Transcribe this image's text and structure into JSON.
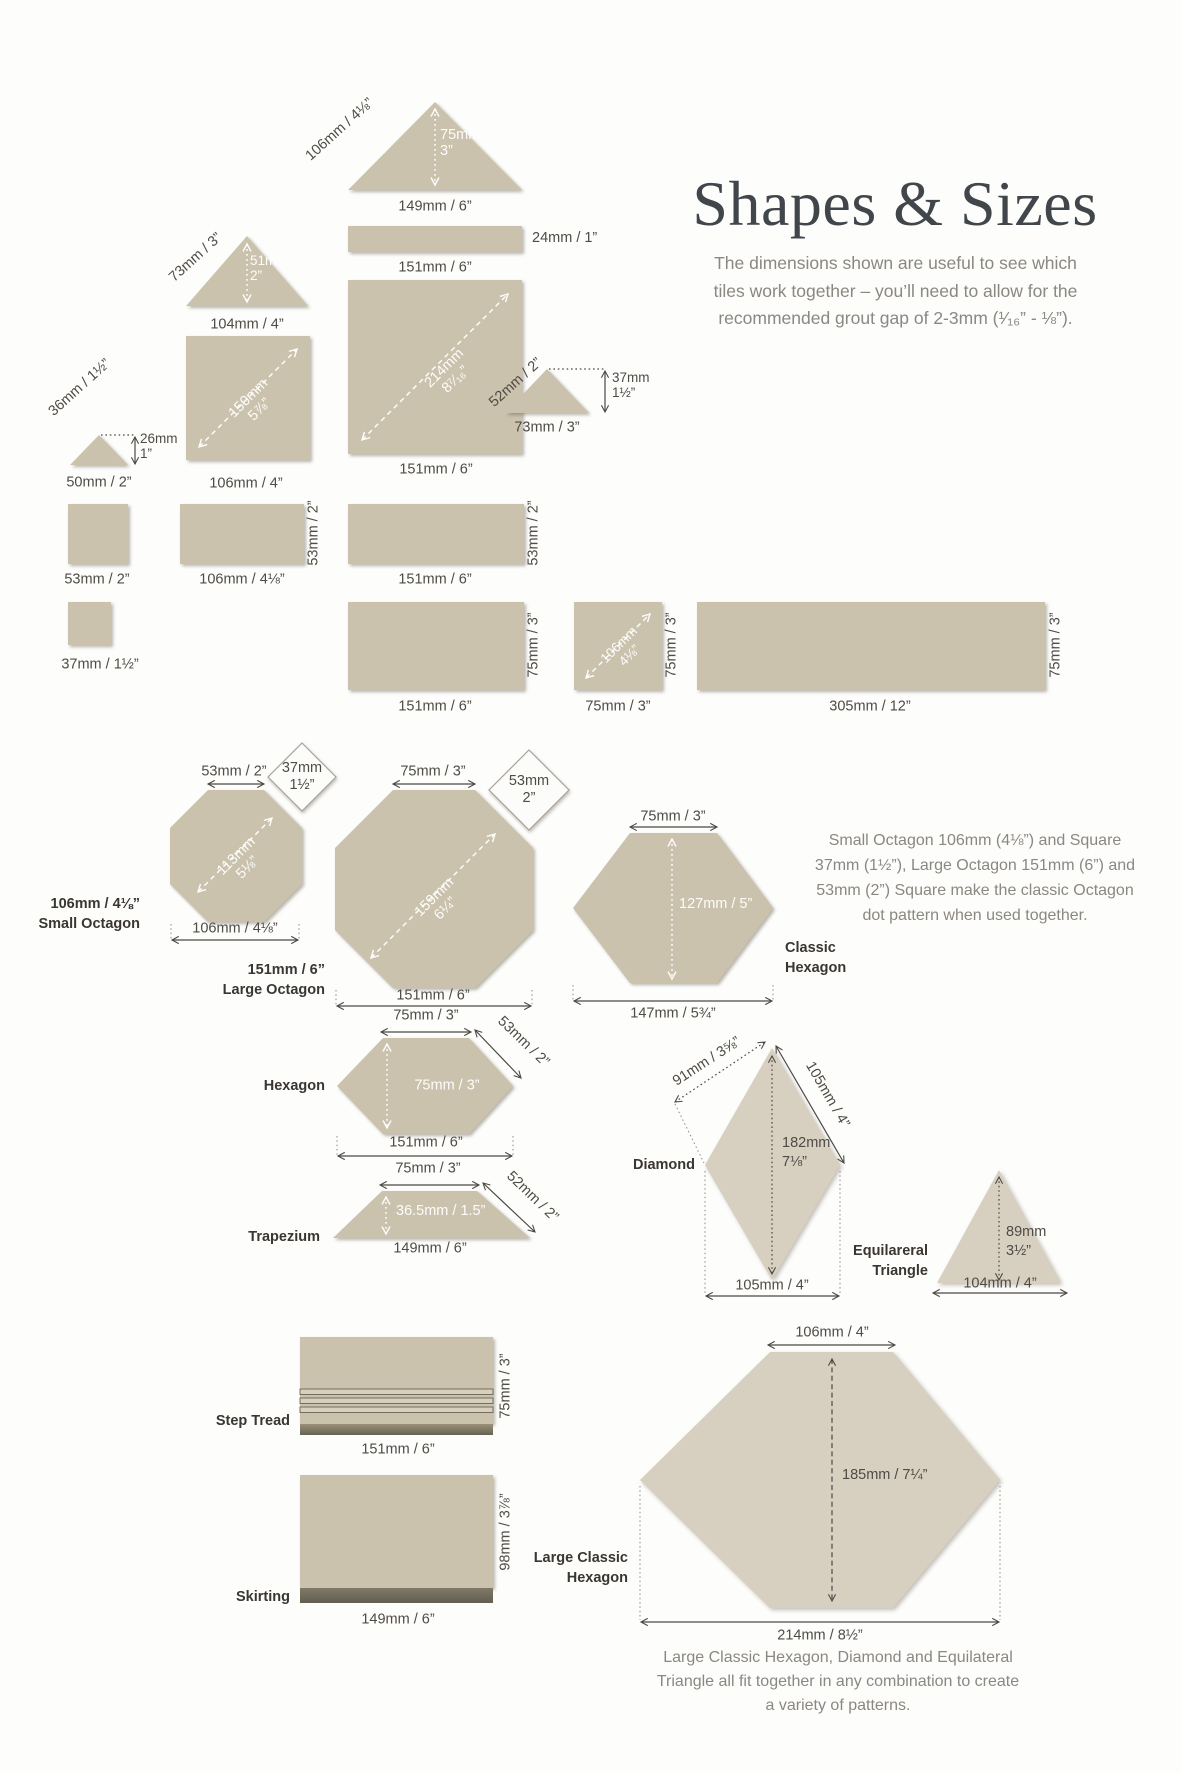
{
  "title": "Shapes & Sizes",
  "intro": {
    "l1": "The dimensions shown are useful to see which",
    "l2": "tiles work together – you’ll need to allow for the",
    "l3": "recommended grout gap of 2-3mm (¹⁄₁₆” - ⅛”)."
  },
  "top": {
    "tri149": {
      "slope": "106mm / 4⅛”",
      "h1": "75mm",
      "h2": "3”",
      "base": "149mm / 6”"
    },
    "strip24": {
      "side": "24mm / 1”",
      "base": "151mm / 6”"
    },
    "sq151": {
      "d1": "214mm",
      "d2": "8⁷⁄₁₆”",
      "base": "151mm / 6”"
    },
    "tri104": {
      "slope": "73mm / 3”",
      "h1": "51mm",
      "h2": "2”",
      "base": "104mm / 4”"
    },
    "sq106": {
      "d1": "150mm",
      "d2": "5⅞”",
      "base": "106mm / 4”"
    },
    "tri50": {
      "slope": "36mm / 1½”",
      "h1": "26mm",
      "h2": "1”",
      "base": "50mm / 2”"
    },
    "tri73": {
      "slope": "52mm / 2”",
      "h1": "37mm",
      "h2": "1½”",
      "base": "73mm / 3”"
    }
  },
  "row53": {
    "sq53": {
      "base": "53mm / 2”"
    },
    "rect106": {
      "side": "53mm / 2”",
      "base": "106mm / 4⅛”"
    },
    "rect151": {
      "side": "53mm / 2”",
      "base": "151mm / 6”"
    }
  },
  "row75": {
    "sq37": {
      "base": "37mm / 1½”"
    },
    "rect151": {
      "side": "75mm / 3”",
      "base": "151mm / 6”"
    },
    "sq75": {
      "d1": "106mm",
      "d2": "4⅛”",
      "side": "75mm / 3”",
      "base": "75mm / 3”"
    },
    "rect305": {
      "side": "75mm / 3”",
      "base": "305mm / 12”"
    }
  },
  "octagons": {
    "small": {
      "top": "53mm / 2”",
      "sq1": "37mm",
      "sq2": "1½”",
      "d1": "113mm",
      "d2": "5⅛”",
      "base": "106mm / 4⅛”",
      "name1": "106mm / 4⅛”",
      "name2": "Small Octagon"
    },
    "large": {
      "top": "75mm / 3”",
      "sq1": "53mm",
      "sq2": "2”",
      "d1": "159mm",
      "d2": "6¼”",
      "base": "151mm / 6”",
      "name1": "151mm / 6”",
      "name2": "Large Octagon"
    },
    "note": {
      "l1": "Small Octagon 106mm (4⅛”) and Square",
      "l2": "37mm (1½”), Large Octagon 151mm (6”) and",
      "l3": "53mm (2”) Square make the classic Octagon",
      "l4": "dot pattern when used together."
    }
  },
  "classic_hex": {
    "top": "75mm / 3”",
    "height": "127mm / 5”",
    "base": "147mm / 5¾”",
    "name1": "Classic",
    "name2": "Hexagon"
  },
  "hexagon": {
    "top": "75mm / 3”",
    "slope": "53mm / 2”",
    "height": "75mm / 3”",
    "base": "151mm / 6”",
    "name": "Hexagon"
  },
  "trapezium": {
    "top": "75mm / 3”",
    "slope": "52mm / 2”",
    "height": "36.5mm / 1.5”",
    "base": "149mm / 6”",
    "name": "Trapezium"
  },
  "diamond": {
    "side_left": "91mm / 3⅝”",
    "side_right": "105mm / 4”",
    "h1": "182mm",
    "h2": "7⅛”",
    "base": "105mm / 4”",
    "name": "Diamond"
  },
  "triangle_eq": {
    "h1": "89mm",
    "h2": "3½”",
    "base": "104mm / 4”",
    "name1": "Equilareral",
    "name2": "Triangle"
  },
  "step_tread": {
    "name": "Step Tread",
    "side": "75mm / 3”",
    "base": "151mm / 6”"
  },
  "skirting": {
    "name": "Skirting",
    "side": "98mm / 3⅞”",
    "base": "149mm / 6”"
  },
  "large_hex": {
    "top": "106mm / 4”",
    "height": "185mm / 7¼”",
    "base": "214mm / 8½”",
    "name1": "Large Classic",
    "name2": "Hexagon"
  },
  "footer": {
    "l1": "Large Classic Hexagon, Diamond and Equilateral",
    "l2": "Triangle all fit together in any combination to create",
    "l3": "a variety of patterns."
  },
  "colors": {
    "tile": "#cbc2ad",
    "tile_light": "#d7cfc0",
    "dim_text": "#4f4b45",
    "muted_text": "#8b8781"
  }
}
